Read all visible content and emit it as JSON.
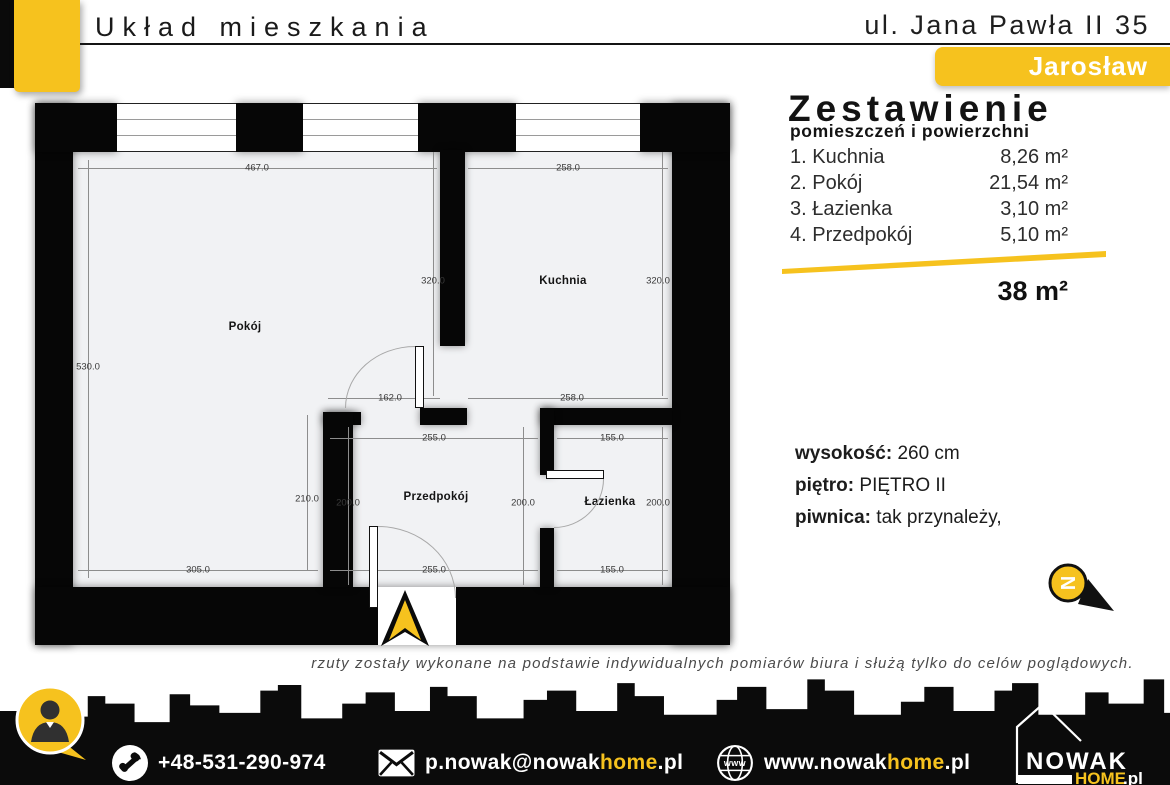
{
  "header": {
    "title": "Układ mieszkania",
    "address": "ul. Jana Pawła II 35",
    "city": "Jarosław"
  },
  "summary": {
    "title": "Zestawienie",
    "subtitle": "pomieszczeń i powierzchni",
    "rooms": [
      {
        "index": "1.",
        "name": "Kuchnia",
        "area": "8,26 m²"
      },
      {
        "index": "2.",
        "name": "Pokój",
        "area": "21,54 m²"
      },
      {
        "index": "3.",
        "name": "Łazienka",
        "area": "3,10 m²"
      },
      {
        "index": "4.",
        "name": "Przedpokój",
        "area": "5,10 m²"
      }
    ],
    "total": "38 m²"
  },
  "details": {
    "height_label": "wysokość:",
    "height_value": "260 cm",
    "floor_label": "piętro:",
    "floor_value": "PIĘTRO II",
    "basement_label": "piwnica:",
    "basement_value": "tak przynależy,"
  },
  "floorplan": {
    "room_labels": {
      "pokoj": "Pokój",
      "kuchnia": "Kuchnia",
      "przedpokoj": "Przedpokój",
      "lazienka": "Łazienka"
    },
    "dims": [
      {
        "label": "467.0"
      },
      {
        "label": "258.0"
      },
      {
        "label": "320.0"
      },
      {
        "label": "320.0"
      },
      {
        "label": "530.0"
      },
      {
        "label": "162.0"
      },
      {
        "label": "258.0"
      },
      {
        "label": "255.0"
      },
      {
        "label": "155.0"
      },
      {
        "label": "210.0"
      },
      {
        "label": "200.0"
      },
      {
        "label": "200.0"
      },
      {
        "label": "200.0"
      },
      {
        "label": "305.0"
      },
      {
        "label": "255.0"
      },
      {
        "label": "155.0"
      }
    ]
  },
  "compass": {
    "letter": "N"
  },
  "disclaimer": {
    "text": "rzuty zostały wykonane na podstawie indywidualnych pomiarów biura i służą tylko do celów poglądowych."
  },
  "footer": {
    "phone": "+48-531-290-974",
    "email": {
      "prefix": "p.nowak@nowak",
      "highlight": "home",
      "suffix": ".pl"
    },
    "website": {
      "prefix": "www.nowak",
      "highlight": "home",
      "suffix": ".pl"
    },
    "globe_text": "www",
    "logo": {
      "name": "NOWAK",
      "home": "HOME",
      "tld": ".pl"
    }
  },
  "colors": {
    "accent": "#F6C21E",
    "wall": "#060606",
    "floor": "#f1f2f4"
  }
}
